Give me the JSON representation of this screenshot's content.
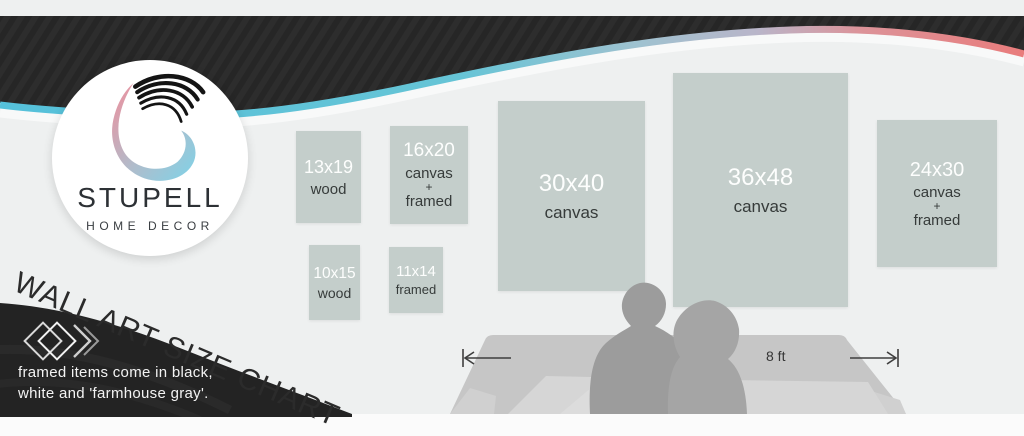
{
  "brand": {
    "name": "STUPELL",
    "subtitle": "HOME DECOR"
  },
  "title": "WALL ART SIZE CHART",
  "note": {
    "line1": "framed items come in black,",
    "line2": "white and 'farmhouse gray'."
  },
  "art": {
    "items": [
      {
        "size": "13x19",
        "label1": "wood"
      },
      {
        "size": "16x20",
        "label1": "canvas",
        "plus": "+",
        "label2": "framed"
      },
      {
        "size": "10x15",
        "label1": "wood"
      },
      {
        "size": "11x14",
        "label1": "framed"
      },
      {
        "size": "30x40",
        "label1": "canvas"
      },
      {
        "size": "36x48",
        "label1": "canvas"
      },
      {
        "size": "24x30",
        "label1": "canvas",
        "plus": "+",
        "label2": "framed"
      }
    ]
  },
  "measurement": {
    "label": "8 ft"
  },
  "colors": {
    "accent_cyan": "#58c2da",
    "accent_pink": "#e97f7f",
    "art_tile": "#c4cecb",
    "band_dark": "#262626",
    "wave_dark": "#232323",
    "wall_bg": "#eef0f0"
  }
}
